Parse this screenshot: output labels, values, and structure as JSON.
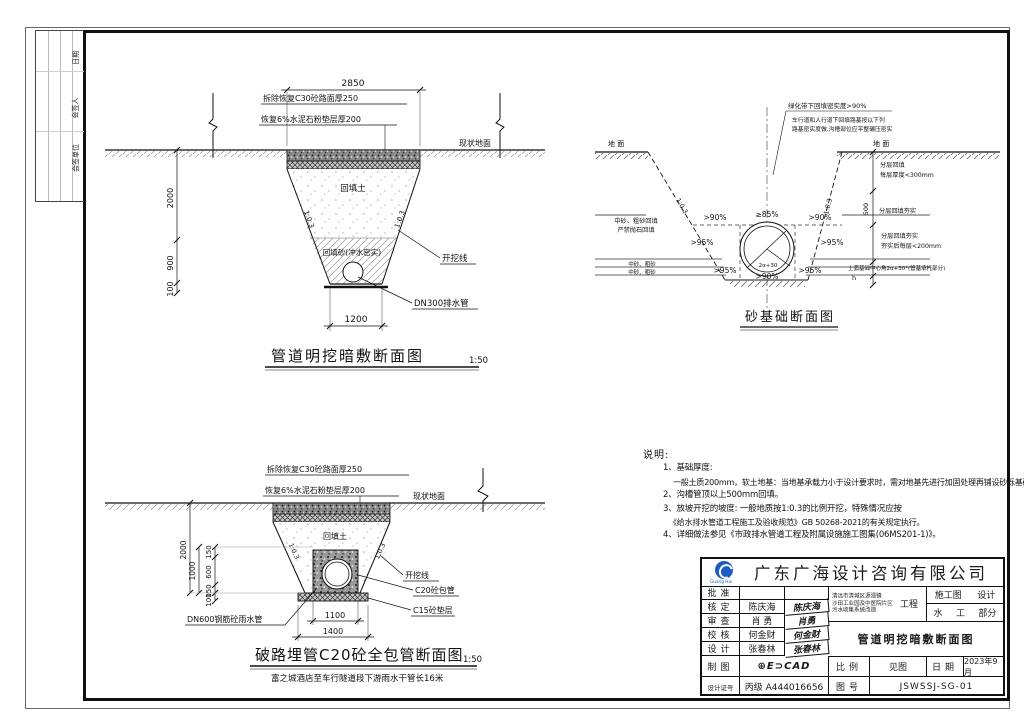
{
  "sheet": {
    "page_bg": "#ffffff",
    "line": "#1a1a1a",
    "accent_blue": "#1b5cc4"
  },
  "sign_strip": {
    "labels": [
      "日期",
      "会签人",
      "会签单位"
    ]
  },
  "d1": {
    "title": "管道明挖暗敷断面图",
    "scale": "1:50",
    "dim_top": "2850",
    "dim_bottom": "1200",
    "dim_left": [
      "2000",
      "900",
      "100"
    ],
    "pav1": "拆除恢复C30砼路面厚250",
    "pav2": "恢复6%水泥石粉垫层厚200",
    "ground": "现状地面",
    "backfill": "回填土",
    "sand": "回填砂(冲水密实)",
    "excav": "开挖线",
    "pipe": "DN300排水管",
    "slope": "1:0.3"
  },
  "d2": {
    "title": "砂基础断面图",
    "ground_l": "地 面",
    "ground_r": "地 面",
    "note1": "绿化带下回填密实度>90%",
    "note2a": "车行道和人行道下回填路基按以下列",
    "note2b": "路基密实度做,沟槽部位应平整碾压密实",
    "pct_t1": ">90%",
    "pct_t2": "≥85%",
    "pct_t3": ">90%",
    "pct_m1": ">95%",
    "pct_m2": ">95%",
    "pct_b1": ">95%",
    "pct_b2": ">95%",
    "pct_b3": ">90%",
    "angle": "2α+30",
    "left1": "中砂、粗砂回填",
    "left2": "严禁抛石回填",
    "left3": "中砂、粗砂",
    "left4": "中砂、粗砂",
    "r1a": "分层回填",
    "r1b": "每层厚度<300mm",
    "dim500": "500",
    "r2": "分层回填夯实",
    "r3a": "分层回填夯实",
    "r3b": "夯实后每层<200mm",
    "r4": "土弧基础中心角2α+30°(管基承托部分)",
    "r4b": "h",
    "slope": "1:0.3"
  },
  "d3": {
    "title": "破路埋管C20砼全包管断面图",
    "scale": "1:50",
    "subtitle": "富之城酒店至车行隧道段下游雨水干管长16米",
    "pav1": "拆除恢复C30砼路面厚250",
    "pav2": "恢复6%水泥石粉垫层厚200",
    "ground": "现状地面",
    "backfill": "回填土",
    "excav": "开挖线",
    "encase": "C20砼包管",
    "bed": "C15砼垫层",
    "pipe": "DN600钢筋砼雨水管",
    "dim_outer": "2000",
    "dim_mid": "1000",
    "dim_chain": [
      "150",
      "600",
      "150",
      "100"
    ],
    "dim_b1": "1100",
    "dim_b2": "1400",
    "slope": "1:0.3"
  },
  "notes": {
    "heading": "说明:",
    "l1": "1、基础厚度:",
    "l1b": "一般土质200mm，软土地基：当地基承载力小于设计要求时，需对地基先进行加固处理再铺设砂砾基础层。",
    "l2": "2、沟槽管顶以上500mm回填。",
    "l3": "3、放坡开挖的坡度: 一般地质按1:0.3的比例开挖，特殊情况应按",
    "l3b": "《给水排水管道工程施工及验收规范》GB 50268-2021的有关规定执行。",
    "l4": "4、详细做法参见《市政排水管道工程及附属设施施工图集(06MS201-1)》。"
  },
  "tb": {
    "company": "广东广海设计咨询有限公司",
    "logo_text": "Guang Hai",
    "rows": [
      {
        "label": "批准",
        "name": "",
        "sig": ""
      },
      {
        "label": "核定",
        "name": "陈庆海",
        "sig": "陈庆海"
      },
      {
        "label": "审查",
        "name": "肖 勇",
        "sig": "肖勇"
      },
      {
        "label": "校核",
        "name": "何金财",
        "sig": "何金财"
      },
      {
        "label": "设计",
        "name": "张春林",
        "sig": "张春林"
      }
    ],
    "draft_label": "制图",
    "draft_value": "⊕E⊃CAD",
    "cert_label": "设计证号",
    "cert_value": "丙级 A444016656",
    "proj1": "清远市清城区源潭镇",
    "proj2": "沙田工业园及中医院片区",
    "proj3": "污水收集系统改造",
    "proj_tag": "工程",
    "stage1": "施工图",
    "stage2": "设计",
    "part1": "水",
    "part2": "工",
    "part3": "部分",
    "dwg_title": "管道明挖暗敷断面图",
    "scale_label": "比例",
    "scale_value": "见图",
    "date_label": "日期",
    "date_value": "2023年9月",
    "no_label": "图号",
    "no_value": "JSWSSJ-SG-01"
  }
}
